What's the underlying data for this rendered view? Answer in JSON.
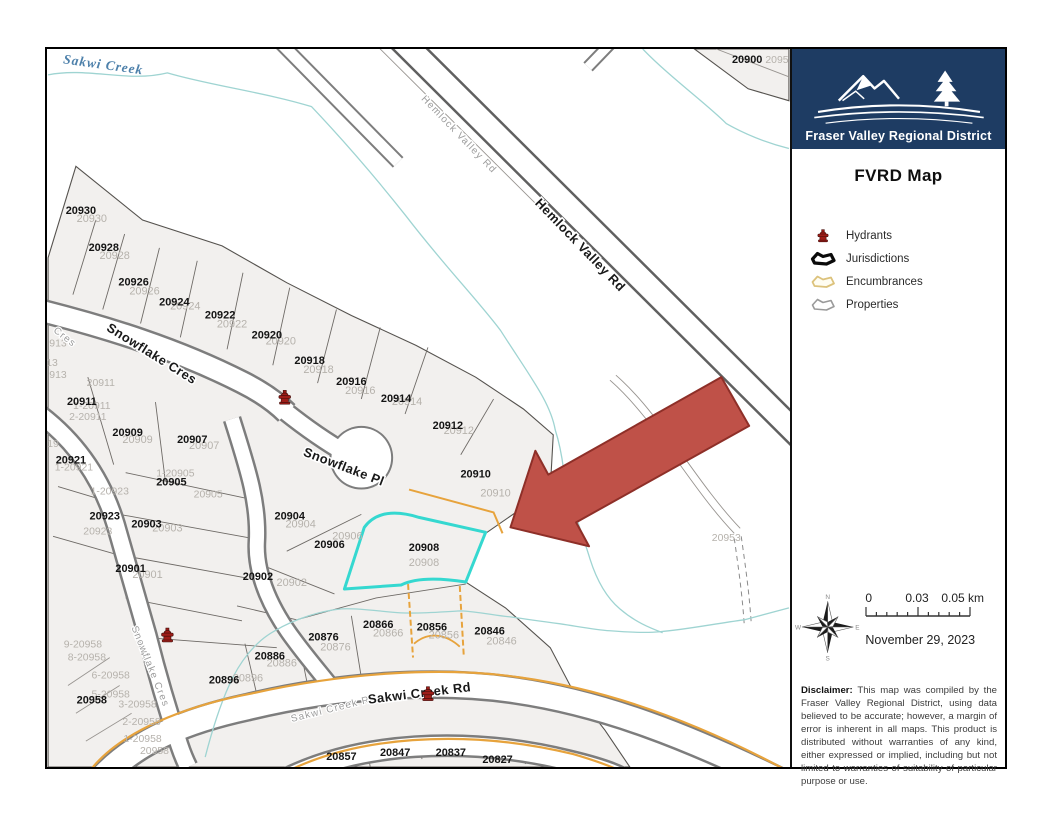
{
  "sidebar": {
    "logo": {
      "org_name": "Fraser Valley Regional District"
    },
    "title": "FVRD Map",
    "legend": [
      {
        "name": "hydrants",
        "label": "Hydrants"
      },
      {
        "name": "jurisdictions",
        "label": "Jurisdictions"
      },
      {
        "name": "encumbrances",
        "label": "Encumbrances"
      },
      {
        "name": "properties",
        "label": "Properties"
      }
    ],
    "compass": {
      "n": "N",
      "e": "E",
      "s": "S",
      "w": "W"
    },
    "scale_bar": {
      "tick0": "0",
      "tick1": "0.03",
      "tick2": "0.05 km"
    },
    "date": "November 29, 2023",
    "disclaimer_label": "Disclaimer:",
    "disclaimer_text": " This map was compiled by the Fraser Valley Regional District, using data believed to be accurate; however, a margin of error is inherent in all maps. This product is distributed without warranties of any kind, either expressed or implied, including but not limited to warranties of suitability of particular purpose or use."
  },
  "map": {
    "creek_label": "Sakwi Creek",
    "road_labels": {
      "hemlock_small": "Hemlock Valley Rd",
      "hemlock_bold": "Hemlock Valley Rd",
      "snowflake_cres_bold": "Snowflake Cres",
      "cres_small": "Cres",
      "snowflake_cres_small": "Snowflake Cres",
      "snowflake_pl_bold": "Snowflake Pl",
      "sakwi_small": "Sakwi Creek Rd",
      "sakwi_bold": "Sakwi Creek Rd"
    },
    "colors": {
      "selected_parcel": "#35d8d0",
      "encumbrance": "#e7a33c",
      "arrow": "#bf5148",
      "hydrant": "#9e1d18",
      "parcel_fill": "#f2f0ee",
      "creek": "#9fd4d2",
      "navy": "#1e3c63"
    },
    "parcels": [
      {
        "label": "20930",
        "x": 33,
        "y": 166,
        "twin": [
          11,
          8
        ]
      },
      {
        "label": "20928",
        "x": 56,
        "y": 203,
        "twin": [
          11,
          8
        ]
      },
      {
        "label": "20926",
        "x": 86,
        "y": 238,
        "twin": [
          11,
          9
        ]
      },
      {
        "label": "20924",
        "x": 127,
        "y": 258,
        "twin": [
          11,
          4
        ]
      },
      {
        "label": "20922",
        "x": 173,
        "y": 271,
        "twin": [
          12,
          9
        ]
      },
      {
        "label": "20920",
        "x": 220,
        "y": 291,
        "twin": [
          14,
          6
        ]
      },
      {
        "label": "20918",
        "x": 263,
        "y": 317,
        "twin": [
          9,
          9
        ]
      },
      {
        "label": "20916",
        "x": 305,
        "y": 338,
        "twin": [
          9,
          9
        ]
      },
      {
        "label": "20914",
        "x": 350,
        "y": 355,
        "twin": [
          11,
          3
        ]
      },
      {
        "label": "20912",
        "x": 402,
        "y": 382,
        "twin": [
          11,
          5
        ]
      },
      {
        "label": "20910",
        "x": 430,
        "y": 431,
        "twin": [
          20,
          19
        ]
      },
      {
        "label": "20908",
        "x": 378,
        "y": 505,
        "twin": [
          0,
          15
        ]
      },
      {
        "label": "20906",
        "x": 283,
        "y": 502,
        "twin": [
          18,
          -9
        ]
      },
      {
        "label": "20904",
        "x": 243,
        "y": 473,
        "twin": [
          11,
          8
        ]
      },
      {
        "label": "20902",
        "x": 211,
        "y": 534,
        "twin": [
          34,
          6
        ]
      },
      {
        "label": "20900",
        "x": 703,
        "y": 14,
        "twin": null
      },
      {
        "label": "20911",
        "x": 34,
        "y": 358,
        "twin": null
      },
      {
        "label": "20909",
        "x": 80,
        "y": 389,
        "twin": [
          10,
          7
        ]
      },
      {
        "label": "20907",
        "x": 145,
        "y": 396,
        "twin": [
          12,
          6
        ]
      },
      {
        "label": "20921",
        "x": 23,
        "y": 417,
        "twin": null
      },
      {
        "label": "20905",
        "x": 124,
        "y": 439,
        "twin": null
      },
      {
        "label": "20923",
        "x": 57,
        "y": 473,
        "twin": null
      },
      {
        "label": "20903",
        "x": 99,
        "y": 481,
        "twin": [
          21,
          4
        ]
      },
      {
        "label": "20901",
        "x": 83,
        "y": 526,
        "twin": [
          17,
          6
        ]
      },
      {
        "label": "20958",
        "x": 44,
        "y": 658,
        "twin": null
      },
      {
        "label": "20896",
        "x": 177,
        "y": 638,
        "twin": [
          24,
          -2
        ]
      },
      {
        "label": "20886",
        "x": 223,
        "y": 614,
        "twin": [
          12,
          7
        ]
      },
      {
        "label": "20876",
        "x": 277,
        "y": 595,
        "twin": [
          12,
          10
        ]
      },
      {
        "label": "20866",
        "x": 332,
        "y": 582,
        "twin": [
          10,
          9
        ]
      },
      {
        "label": "20856",
        "x": 386,
        "y": 585,
        "twin": [
          12,
          8
        ]
      },
      {
        "label": "20846",
        "x": 444,
        "y": 589,
        "twin": [
          12,
          10
        ]
      },
      {
        "label": "20857",
        "x": 295,
        "y": 715,
        "twin": null
      },
      {
        "label": "20847",
        "x": 349,
        "y": 711,
        "twin": null
      },
      {
        "label": "20837",
        "x": 405,
        "y": 711,
        "twin": null
      },
      {
        "label": "20827",
        "x": 452,
        "y": 718,
        "twin": null
      }
    ],
    "unit_labels": [
      {
        "label": "913",
        "x": 10,
        "y": 299
      },
      {
        "label": "13",
        "x": 4,
        "y": 319
      },
      {
        "label": "913",
        "x": 10,
        "y": 331
      },
      {
        "label": "19",
        "x": 5,
        "y": 400
      },
      {
        "label": "20911",
        "x": 53,
        "y": 339
      },
      {
        "label": "1-20911",
        "x": 44,
        "y": 362
      },
      {
        "label": "2-20911",
        "x": 40,
        "y": 373
      },
      {
        "label": "1-20921",
        "x": 26,
        "y": 424
      },
      {
        "label": "1-20905",
        "x": 128,
        "y": 430
      },
      {
        "label": "20905",
        "x": 161,
        "y": 451
      },
      {
        "label": "1-20923",
        "x": 62,
        "y": 448
      },
      {
        "label": "20923",
        "x": 50,
        "y": 488
      },
      {
        "label": "9-20958",
        "x": 35,
        "y": 602
      },
      {
        "label": "8-20958",
        "x": 39,
        "y": 615
      },
      {
        "label": "6-20958",
        "x": 63,
        "y": 633
      },
      {
        "label": "5-20958",
        "x": 63,
        "y": 652
      },
      {
        "label": "3-20958",
        "x": 90,
        "y": 662
      },
      {
        "label": "2-20958",
        "x": 94,
        "y": 680
      },
      {
        "label": "1-20958",
        "x": 95,
        "y": 697
      },
      {
        "label": "20958",
        "x": 107,
        "y": 709
      },
      {
        "label": "20953",
        "x": 682,
        "y": 495
      },
      {
        "label": "2095",
        "x": 733,
        "y": 14
      }
    ],
    "hydrants": [
      {
        "x": 238,
        "y": 350
      },
      {
        "x": 120,
        "y": 589
      },
      {
        "x": 382,
        "y": 648
      }
    ]
  }
}
